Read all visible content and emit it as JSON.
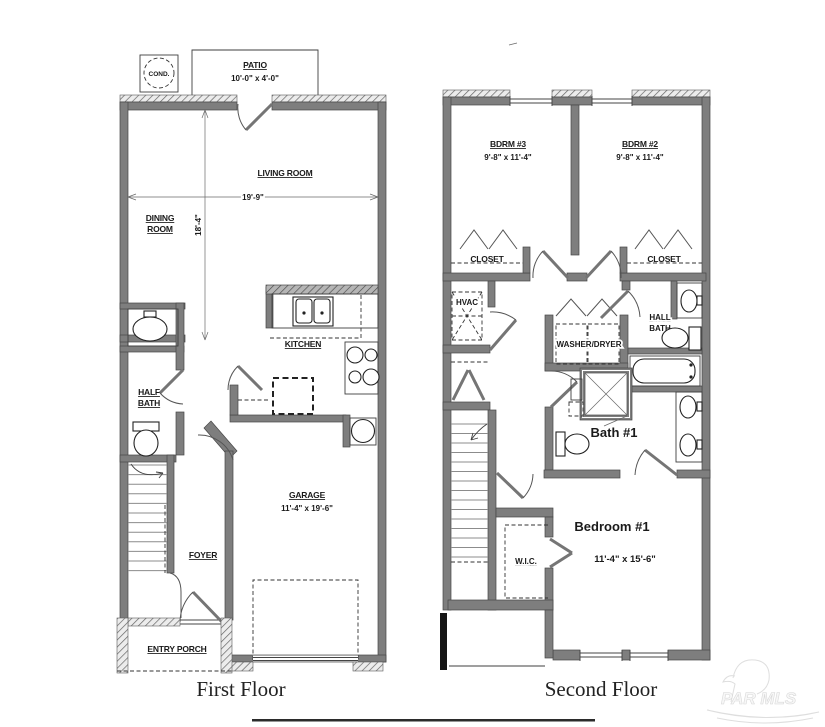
{
  "document": {
    "type": "floor-plan",
    "floors": [
      "First Floor",
      "Second Floor"
    ]
  },
  "colors": {
    "background": "#ffffff",
    "wall_gray": "#7e7e7e",
    "wall_edge": "#474747",
    "hatch_line": "#666666",
    "text": "#1a1a1a",
    "black_bar": "#151515",
    "watermark": "#dedede",
    "bottom_rule": "#2b2b2b"
  },
  "first_floor": {
    "title": "First Floor",
    "labels": {
      "cond": "COND.",
      "patio": "PATIO",
      "patio_dim": "10'-0\" x 4'-0\"",
      "living_room": "LIVING ROOM",
      "dim_width": "19'-9\"",
      "dim_height": "18'-4\"",
      "dining_line1": "DINING",
      "dining_line2": "ROOM",
      "kitchen": "KITCHEN",
      "half_bath_line1": "HALF",
      "half_bath_line2": "BATH",
      "foyer": "FOYER",
      "garage": "GARAGE",
      "garage_dim": "11'-4\" x 19'-6\"",
      "entry_porch": "ENTRY PORCH"
    }
  },
  "second_floor": {
    "title": "Second Floor",
    "labels": {
      "bdrm3": "BDRM #3",
      "bdrm3_dim": "9'-8\" x 11'-4\"",
      "bdrm2": "BDRM #2",
      "bdrm2_dim": "9'-8\" x 11'-4\"",
      "closet_left": "CLOSET",
      "closet_right": "CLOSET",
      "hvac": "HVAC",
      "washer_dryer": "WASHER/DRYER",
      "hall_bath_line1": "HALL",
      "hall_bath_line2": "BATH",
      "bath1": "Bath #1",
      "wic": "W.I.C.",
      "bedroom1": "Bedroom #1",
      "bedroom1_dim": "11'-4\" x 15'-6\""
    }
  },
  "watermark": {
    "text": "PAR MLS"
  }
}
